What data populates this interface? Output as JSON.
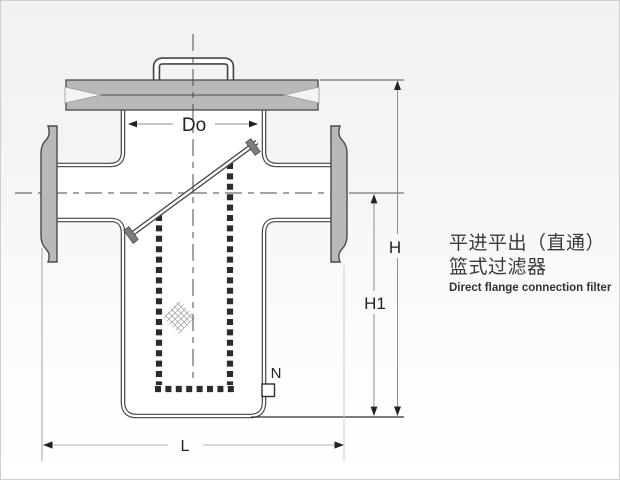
{
  "diagram": {
    "type": "technical-drawing",
    "title": {
      "zh_line1": "平进平出（直通）",
      "zh_line2": "篮式过滤器",
      "en_subtitle": "Direct flange connection filter"
    },
    "dimension_labels": {
      "basket_diameter": "Do",
      "overall_height": "H",
      "lower_height": "H1",
      "face_to_face_length": "L",
      "drain_port": "N"
    },
    "colors": {
      "metal_fill": "#b9b9b9",
      "outline": "#444444",
      "dim_line": "#8c8c8c",
      "text": "#333333"
    }
  }
}
